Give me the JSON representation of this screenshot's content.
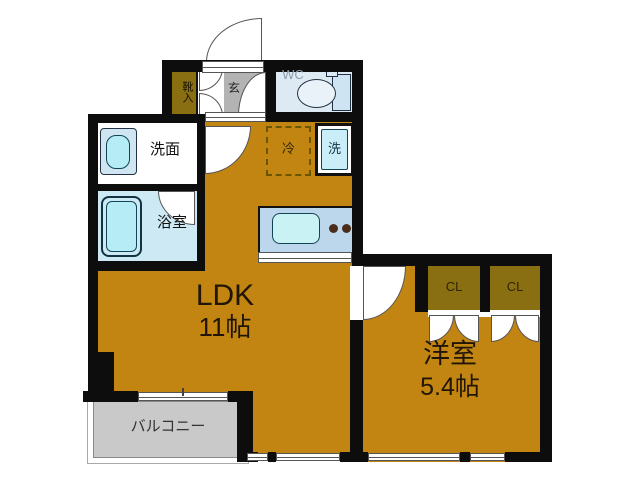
{
  "plan": {
    "title": "1LDK floor plan",
    "rooms": {
      "ldk": {
        "label": "LDK",
        "size": "11帖"
      },
      "bedroom": {
        "label": "洋室",
        "size": "5.4帖"
      },
      "balcony": {
        "label": "バルコニー"
      },
      "washroom": {
        "label": "洗面"
      },
      "bathroom": {
        "label": "浴室"
      },
      "wc": {
        "label": "WC"
      },
      "entrance": {
        "label": "玄"
      },
      "shoe_cabinet": {
        "label": "靴入"
      },
      "closet_left": {
        "label": "CL"
      },
      "closet_right": {
        "label": "CL"
      },
      "refrigerator": {
        "label": "冷"
      },
      "washing_machine": {
        "label": "洗"
      }
    },
    "colors": {
      "room_fill": "#c28512",
      "closet_fill": "#8a6e12",
      "wall": "#0d0d0d",
      "entrance_floor": "#b3b3b3",
      "balcony_floor": "#c9c9c9",
      "water_blue": "#cde9f4",
      "fixture_cyan": "#b5ecf6",
      "counter_blue": "#bcd7ec"
    }
  }
}
